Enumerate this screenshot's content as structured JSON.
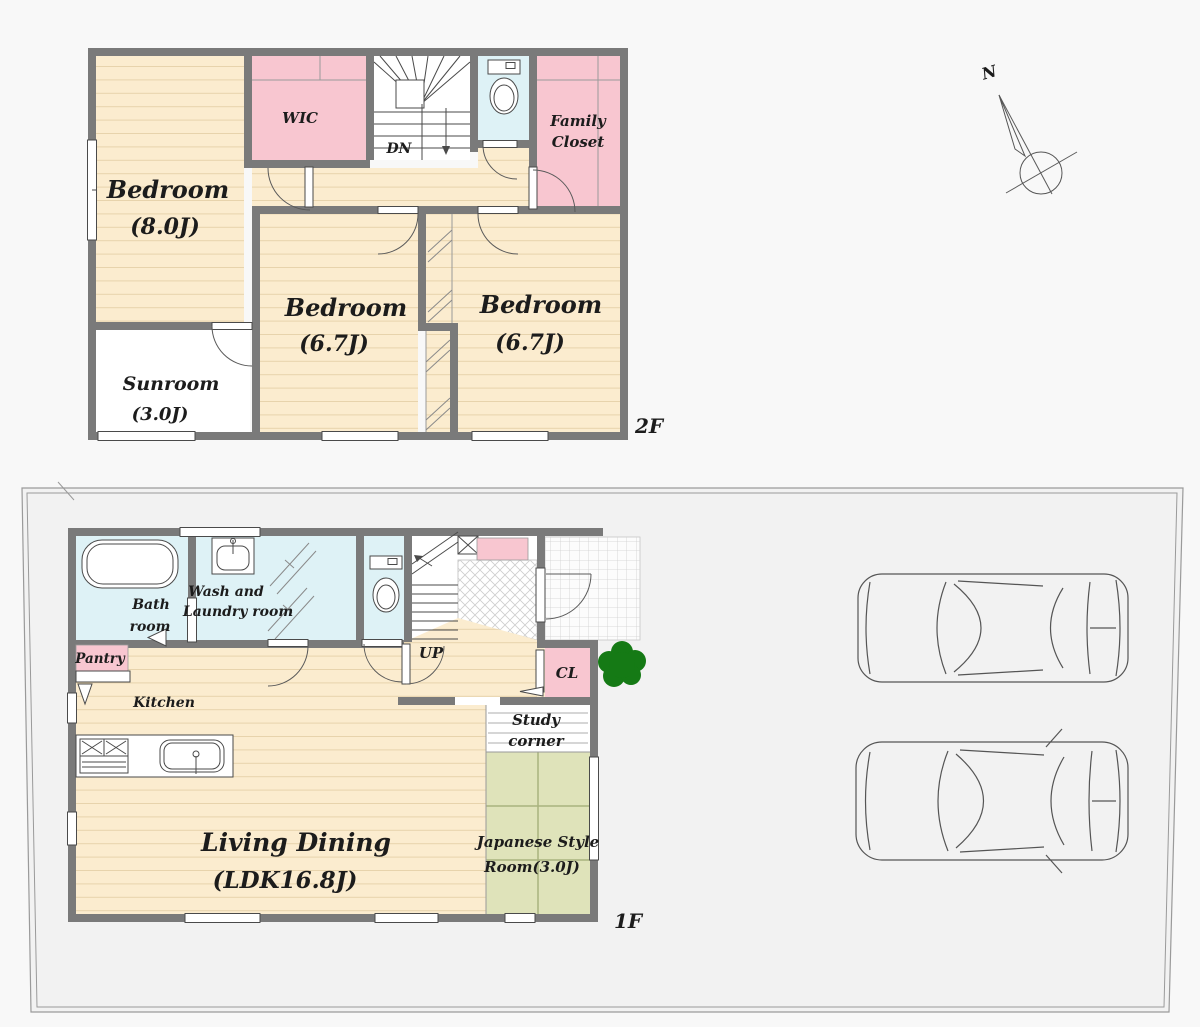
{
  "colors": {
    "background": "#f8f8f8",
    "plot_fill": "#f2f2f2",
    "wall_gray": "#7a7a7a",
    "floor_tan": "#fbeccf",
    "floor_line_tan": "#e7d3ac",
    "closet_pink": "#f8c6d0",
    "wet_room_blue": "#def2f6",
    "tatami_green": "#dfe3ba",
    "tree_green": "#157a15"
  },
  "compass": {
    "north_label": "N"
  },
  "floor2": {
    "tag": "2F",
    "bedroom_main": {
      "name": "Bedroom",
      "size": "(8.0J)"
    },
    "wic": {
      "label": "WIC"
    },
    "stairs": {
      "label": "DN"
    },
    "family_closet": {
      "line1": "Family",
      "line2": "Closet"
    },
    "bedroom_center": {
      "name": "Bedroom",
      "size": "(6.7J)"
    },
    "bedroom_right": {
      "name": "Bedroom",
      "size": "(6.7J)"
    },
    "sunroom": {
      "name": "Sunroom",
      "size": "(3.0J)"
    }
  },
  "floor1": {
    "tag": "1F",
    "bath": {
      "line1": "Bath",
      "line2": "room"
    },
    "laundry": {
      "line1": "Wash and",
      "line2": "Laundry room"
    },
    "stairs": {
      "label": "UP"
    },
    "closet": {
      "label": "CL"
    },
    "pantry": {
      "label": "Pantry"
    },
    "kitchen": {
      "label": "Kitchen"
    },
    "living_dining": {
      "line1": "Living Dining",
      "line2": "(LDK16.8J)"
    },
    "study": {
      "line1": "Study",
      "line2": "corner"
    },
    "japanese_room": {
      "line1": "Japanese Style",
      "line2": "Room(3.0J)"
    }
  }
}
